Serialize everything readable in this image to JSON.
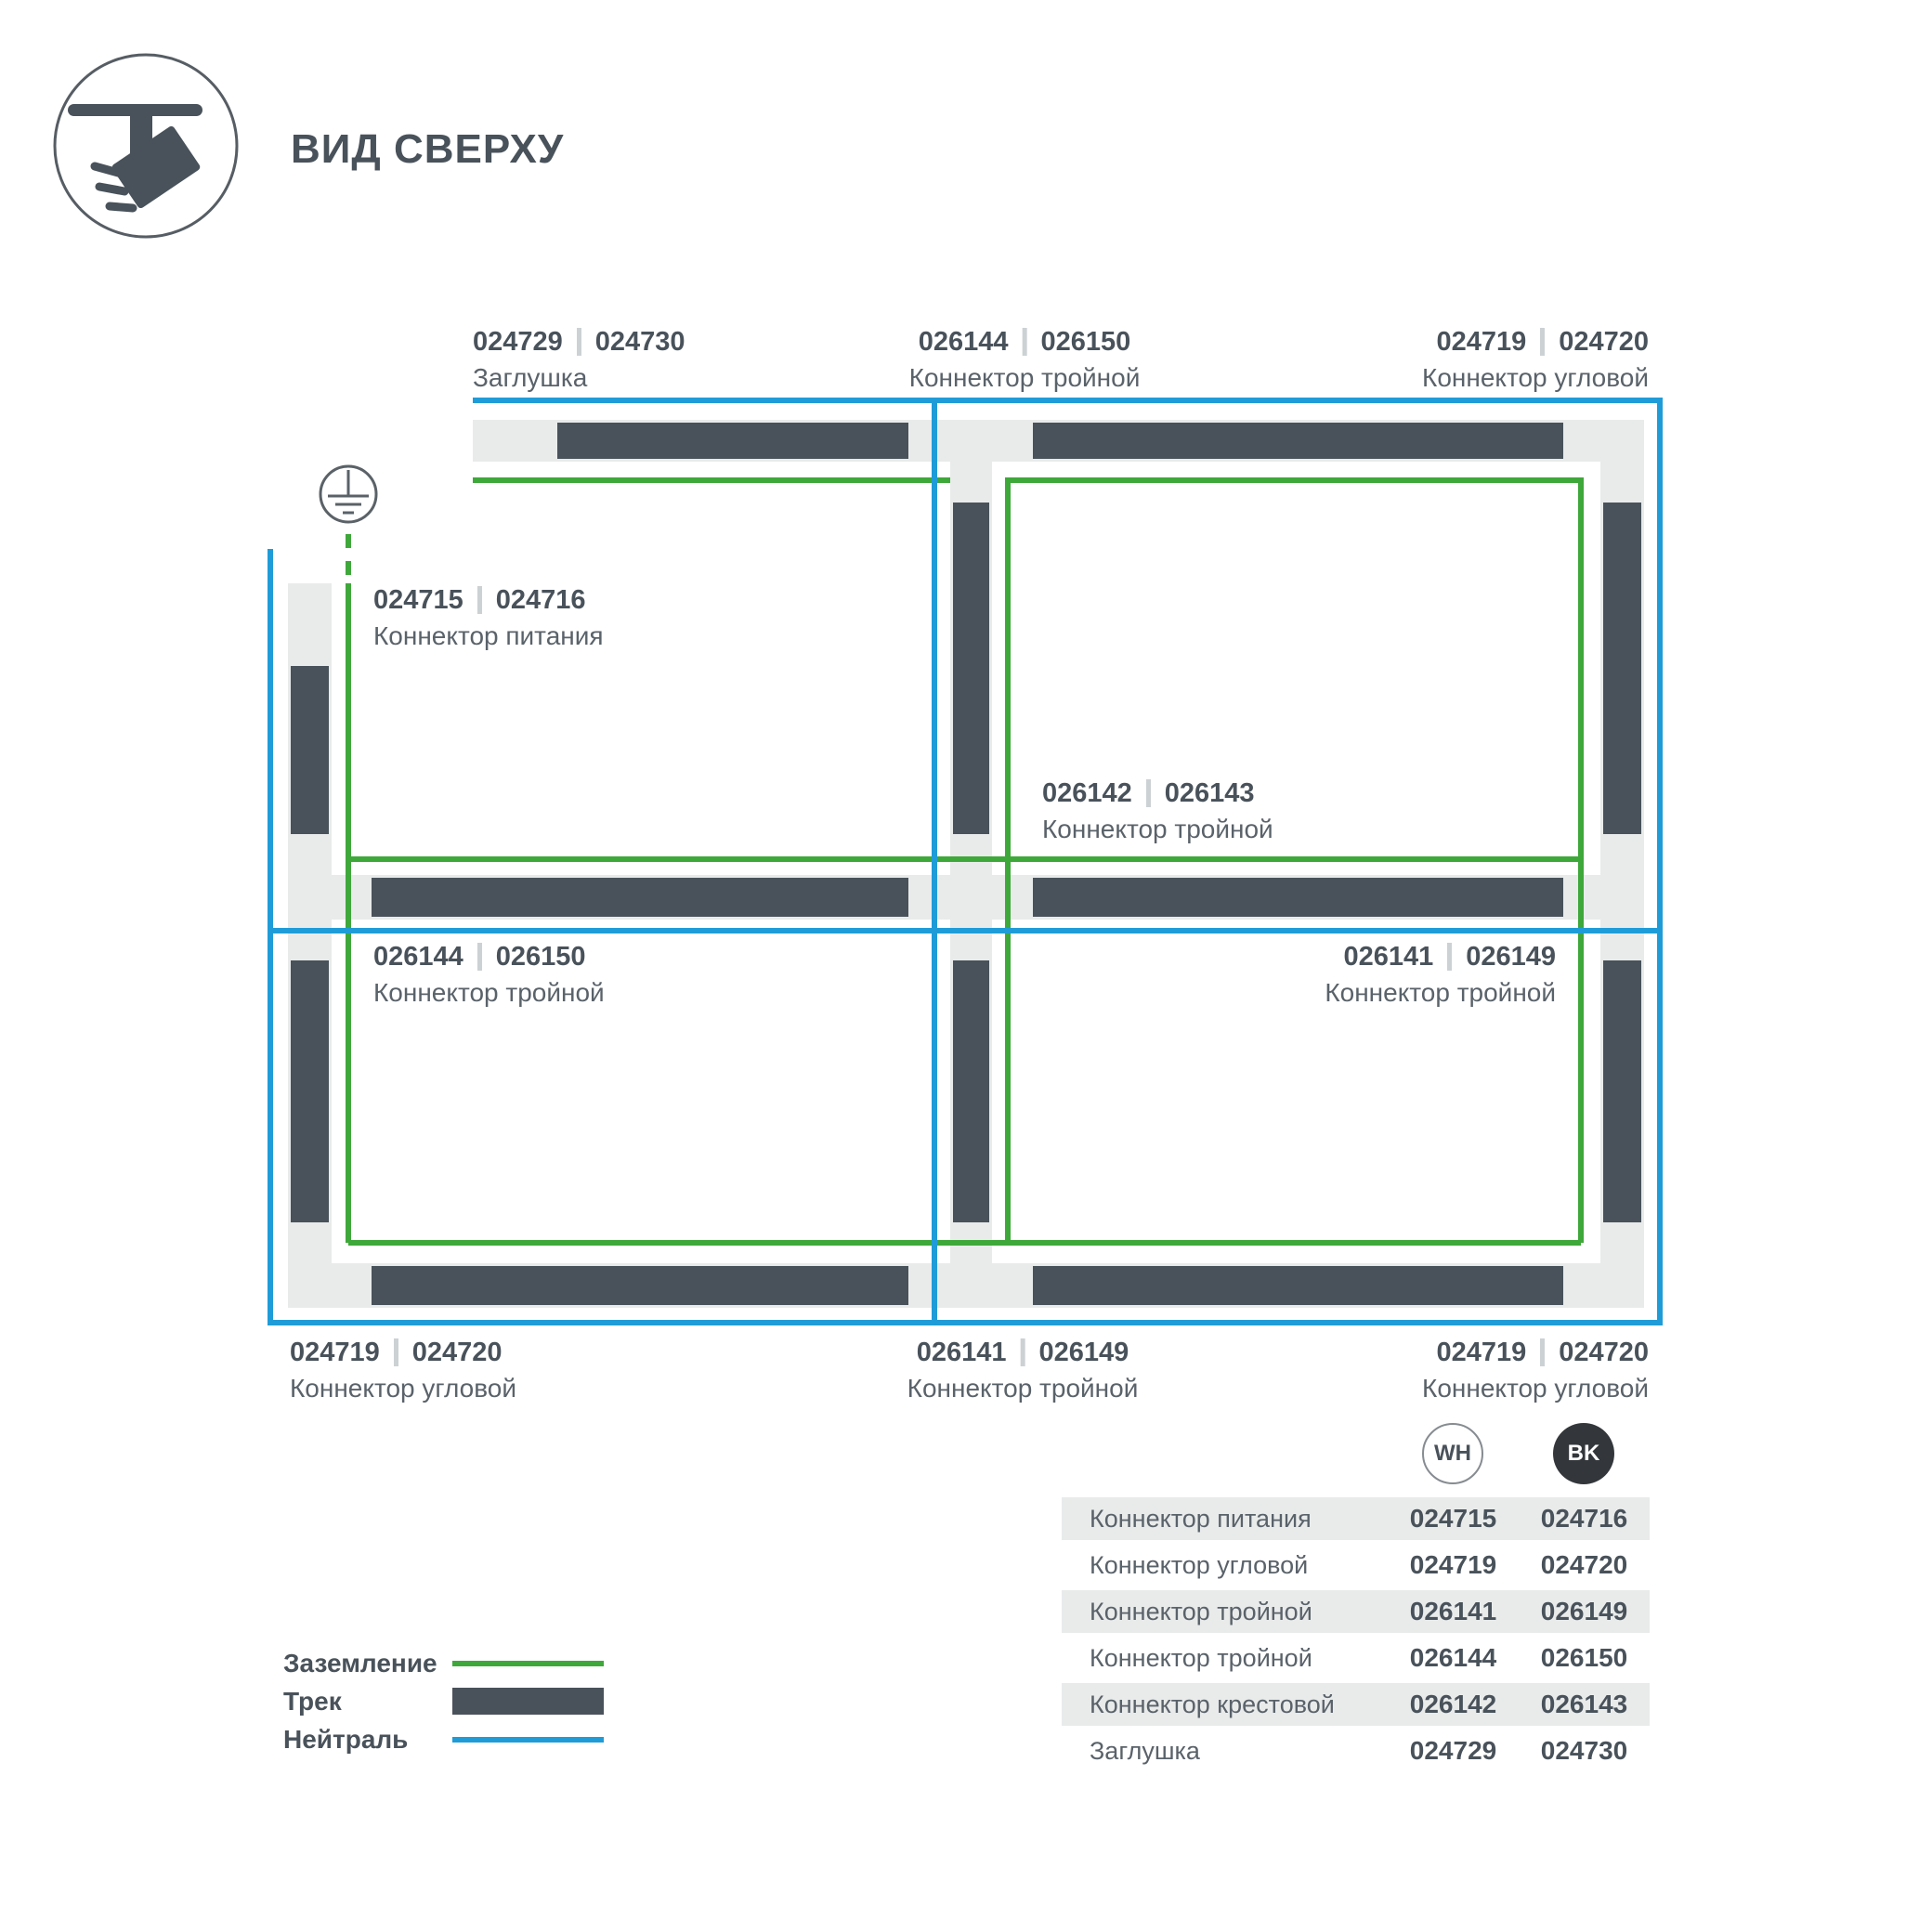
{
  "header": {
    "title": "ВИД СВЕРХУ"
  },
  "palette": {
    "track_dark": "#49525a",
    "track_light": "#e9ebeb",
    "ground_green": "#3fa83a",
    "neutral_blue": "#1f9cd8",
    "text_primary": "#49525a",
    "text_secondary": "#5a626a"
  },
  "diagram": {
    "labels": {
      "top_left": {
        "code_wh": "024729",
        "code_bk": "024730",
        "name": "Заглушка"
      },
      "top_center": {
        "code_wh": "026144",
        "code_bk": "026150",
        "name": "Коннектор тройной"
      },
      "top_right": {
        "code_wh": "024719",
        "code_bk": "024720",
        "name": "Коннектор угловой"
      },
      "power": {
        "code_wh": "024715",
        "code_bk": "024716",
        "name": "Коннектор питания"
      },
      "cross": {
        "code_wh": "026142",
        "code_bk": "026143",
        "name": "Коннектор тройной"
      },
      "mid_left": {
        "code_wh": "026144",
        "code_bk": "026150",
        "name": "Коннектор тройной"
      },
      "mid_right": {
        "code_wh": "026141",
        "code_bk": "026149",
        "name": "Коннектор тройной"
      },
      "bottom_left": {
        "code_wh": "024719",
        "code_bk": "024720",
        "name": "Коннектор угловой"
      },
      "bottom_center": {
        "code_wh": "026141",
        "code_bk": "026149",
        "name": "Коннектор тройной"
      },
      "bottom_right": {
        "code_wh": "024719",
        "code_bk": "024720",
        "name": "Коннектор угловой"
      }
    }
  },
  "legend": {
    "items": [
      {
        "label": "Заземление"
      },
      {
        "label": "Трек"
      },
      {
        "label": "Нейтраль"
      }
    ]
  },
  "table": {
    "col_wh": "WH",
    "col_bk": "BK",
    "rows": [
      {
        "name": "Коннектор питания",
        "wh": "024715",
        "bk": "024716"
      },
      {
        "name": "Коннектор угловой",
        "wh": "024719",
        "bk": "024720"
      },
      {
        "name": "Коннектор тройной",
        "wh": "026141",
        "bk": "026149"
      },
      {
        "name": "Коннектор тройной",
        "wh": "026144",
        "bk": "026150"
      },
      {
        "name": "Коннектор крестовой",
        "wh": "026142",
        "bk": "026143"
      },
      {
        "name": "Заглушка",
        "wh": "024729",
        "bk": "024730"
      }
    ]
  }
}
